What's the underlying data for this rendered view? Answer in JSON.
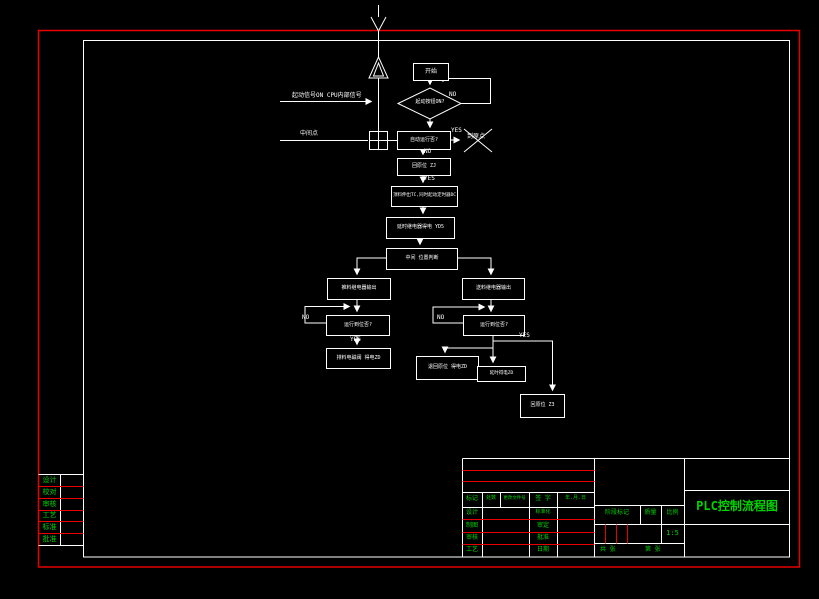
{
  "colors": {
    "background": "#000000",
    "frame_red": "#e60000",
    "line_white": "#ffffff",
    "text_green": "#00d400"
  },
  "flow": {
    "start": "开始",
    "decision_start": "起动按钮ON?",
    "signal_cpu": "起动信号ON CPU内部信号",
    "signal_mid": "中间点",
    "q_auto": "自动运行否?",
    "to_origin": "到原点",
    "origin_zj": "回原位 ZJ",
    "tc": "顶料伸出TC,同时起动定时器DC",
    "yd5": "延时继电器得电 YD5",
    "mid_judge": "中间 位置判断",
    "left_out": "推料继电器输出",
    "right_out": "送料继电器输出",
    "left_check": "运行到位否?",
    "right_check": "运行到位否?",
    "left_final": "排料电磁阀 得电ZD",
    "mid_box1": "退回原位 得电ZD",
    "mid_box2": "延时得电ZD",
    "z3": "回原位 Z3",
    "yes": "YES",
    "no": "NO"
  },
  "title_block": {
    "header": [
      "标记",
      "处数",
      "更改文件号",
      "签 字",
      "年.月.日"
    ],
    "rows_left": [
      "设计",
      "制图",
      "审核",
      "工艺"
    ],
    "rows_mid": [
      "标准化",
      "审定",
      "批准",
      "日期"
    ],
    "stage": "阶段标记",
    "weight": "质量",
    "scale_label": "比例",
    "scale_value": "1:5",
    "sheet_left": "共  张",
    "sheet_right": "第  张",
    "title": "PLC控制流程图"
  },
  "signature_table": {
    "rows": [
      "设计",
      "校对",
      "审核",
      "工艺",
      "标准",
      "批准"
    ]
  }
}
